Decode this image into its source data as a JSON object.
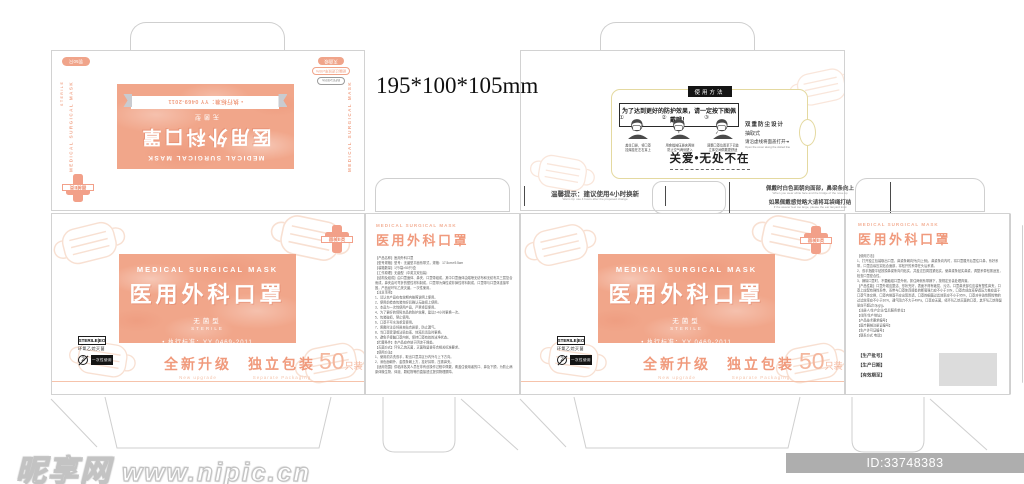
{
  "size_label": "195*100*105mm",
  "brand": {
    "title_en": "MEDICAL SURGICAL MASK",
    "title_cn": "医用外科口罩",
    "sterile_cn": "无菌型",
    "sterile_en": "STERILE",
    "standard": "• 执行标准：YY 0469-2011",
    "upgrade_cn": "全新升级",
    "upgrade_en": "New upgrade",
    "packing_cn": "独立包装",
    "packing_en": "Separate Packaging",
    "count_num": "50",
    "count_unit": "只装",
    "device_class": "器械Ⅱ类",
    "badge_pack": "装50只",
    "pill_top": "灭菌级",
    "pill_mid": "细菌过滤效率≥95%",
    "pill_bottom": "BFE≥95%",
    "icon_sterile_eo": "STERILE|EO",
    "icon_sterile_caption": "环氧乙烷灭菌",
    "icon_no_reuse_num": "2",
    "icon_single_use": "一次性使用",
    "side_flap_text": "MEDICAL SURGICAL MASK",
    "side_flap_text2": "STERILE"
  },
  "usage_panel": {
    "tab": "使用方法",
    "notice": "为了达到更好的防护效果，请一定按下图佩戴哦！",
    "steps": [
      {
        "num": "①",
        "caption": "盖住口鼻，将口罩\n挂绳挂在左右耳上"
      },
      {
        "num": "②",
        "caption": "用食指按压鼻夹两侧\n防止空气两侧进入"
      },
      {
        "num": "③",
        "caption": "调整口罩位置至下巴处\n立体空间佩戴更舒适"
      }
    ],
    "note_1": "双重防尘设计",
    "note_2": "抽取式",
    "note_3": "请沿虚线将面盖打开↠",
    "note_en": "Open the cover along the dotted line",
    "slogan": "关爱•无处不在"
  },
  "tips": {
    "left_cn": "温馨提示：建议使用4小时换新",
    "left_en": "Warm tip: use 4 hours after the proposed change",
    "right_cn_1": "佩戴时白色面朝向面部，鼻梁条向上",
    "right_en_1": "When you wear white face and the bridge of the nose up",
    "right_cn_2": "如果佩戴感觉略大请将耳袋绳打结",
    "right_en_2": "If the wearer feel too large, please the ear lanyard knot"
  },
  "left_back_panel": {
    "title_en": "MEDICAL SURGICAL MASK",
    "title_cn": "医用外科口罩",
    "text": "【产品名称】医用外科口罩\n【型号规格】型号：无菌型平面系带式，规格：17.5cm×9.5cm\n【装箱数量】1只/袋×50只/盒\n【工作原理】无菌型（中英文双包装）\n【结构及组成】由口罩面体、鼻夹、口罩带组成，其中口罩面体由熔喷无纺布和无纺布共三层复合而成，鼻夹由可弯折的塑性材料制成，口罩带为弹性或非弹性材料制成，口罩带与口罩体连接牢固，产品经环氧乙烷灭菌，一次性使用。\n【注意事项】\n1、请认本产品在有效期内按照说明上使用。\n2、使用前检查包装完好后确认无破损上使用。\n3、本品为一次性使用产品，严禁重复使用。\n4、为了更好的保障本品的防护效果，建议2-4小时更换一次。\n5、包装破损，禁止使用。\n6、口罩不可水洗重复使用。\n7、佩戴时注意将鼻夹贴合鼻梁，防止漏气。\n8、当口罩受潮或沾染血液、体液后请及时更换。\n9、避免手接触口罩内侧，保持口罩有效的洁净状态。\n【贮藏条件】本产品应存放于阴凉干燥处。\n【灭菌方式】环氧乙烷灭菌，灭菌残留量符合相关标准要求。\n【使用方法】\n1、使用前清洗双手，取出口罩并区分内外与上下方向。\n2、深色面朝外，金属条朝上方，挂好耳带，压紧鼻夹。\n【适用范围】供临床各类人员在非有创操作过程中佩戴，覆盖住使用者的口、鼻及下颌，为防止病原体微生物、体液、颗粒物等的直接透过提供物理屏障。"
  },
  "right_back_panel": {
    "title_en": "MEDICAL SURGICAL MASK",
    "title_cn": "医用外科口罩",
    "text": "【使用方法】\n1、打开独立包装取出口罩，鼻梁条朝向外(向上侧)，鼻梁条向内时，将口罩展开后罩住口鼻，系好系带，口罩边缘压实贴合面部，将松开的系带在头后系紧。\n2、双手指腹平贴按摸鼻梁条向内贴实，并盖过四周捏紧贴实，使鼻梁条贴实鼻梁，调整系带松紧适宜，检查口罩密合性。\n3、摘除口罩时，不要触碰口罩外侧，抓住两侧系带摘下，按规定妥善处理弃置。\n【产品性能】口罩外观应整洁、形状完好，表面不得有破损、污渍，口罩鼻夹部位应装有塑性鼻夹，口罩上应配有弹性系带，系带与口罩体连接处的断裂强力应不小于10N，口罩合成血液穿透压力差应适于口罩气体交换，口罩内侧面不应出现渗透，口罩的细菌过滤效率应不小于95%，口罩对非油性颗粒物的过滤效率应不小于30%，通气阻力不大于49Pa，口罩应无菌，经环氧乙烷灭菌的口罩，其环氧乙烷残留量应不超过10μg/g。\n【注册人/生产企业/售后服务单位】\n【住所/生产地址】\n【产品技术要求编号】\n【医疗器械注册证编号】\n【生产许可证编号】\n【联系方式 电话】",
    "fields": "【生产批号】\n【生产日期】\n【有效期至】"
  },
  "watermark": {
    "site": "昵享网",
    "url": "www.nipic.cn",
    "id_bar": "ID:33748383 NO:20221227144932385102"
  },
  "colors": {
    "salmon": "#f1a68a",
    "salmon_text": "#ef9d80",
    "dieline": "#cfcfcf",
    "cream_border": "#e4d9a0",
    "ink": "#333333"
  }
}
